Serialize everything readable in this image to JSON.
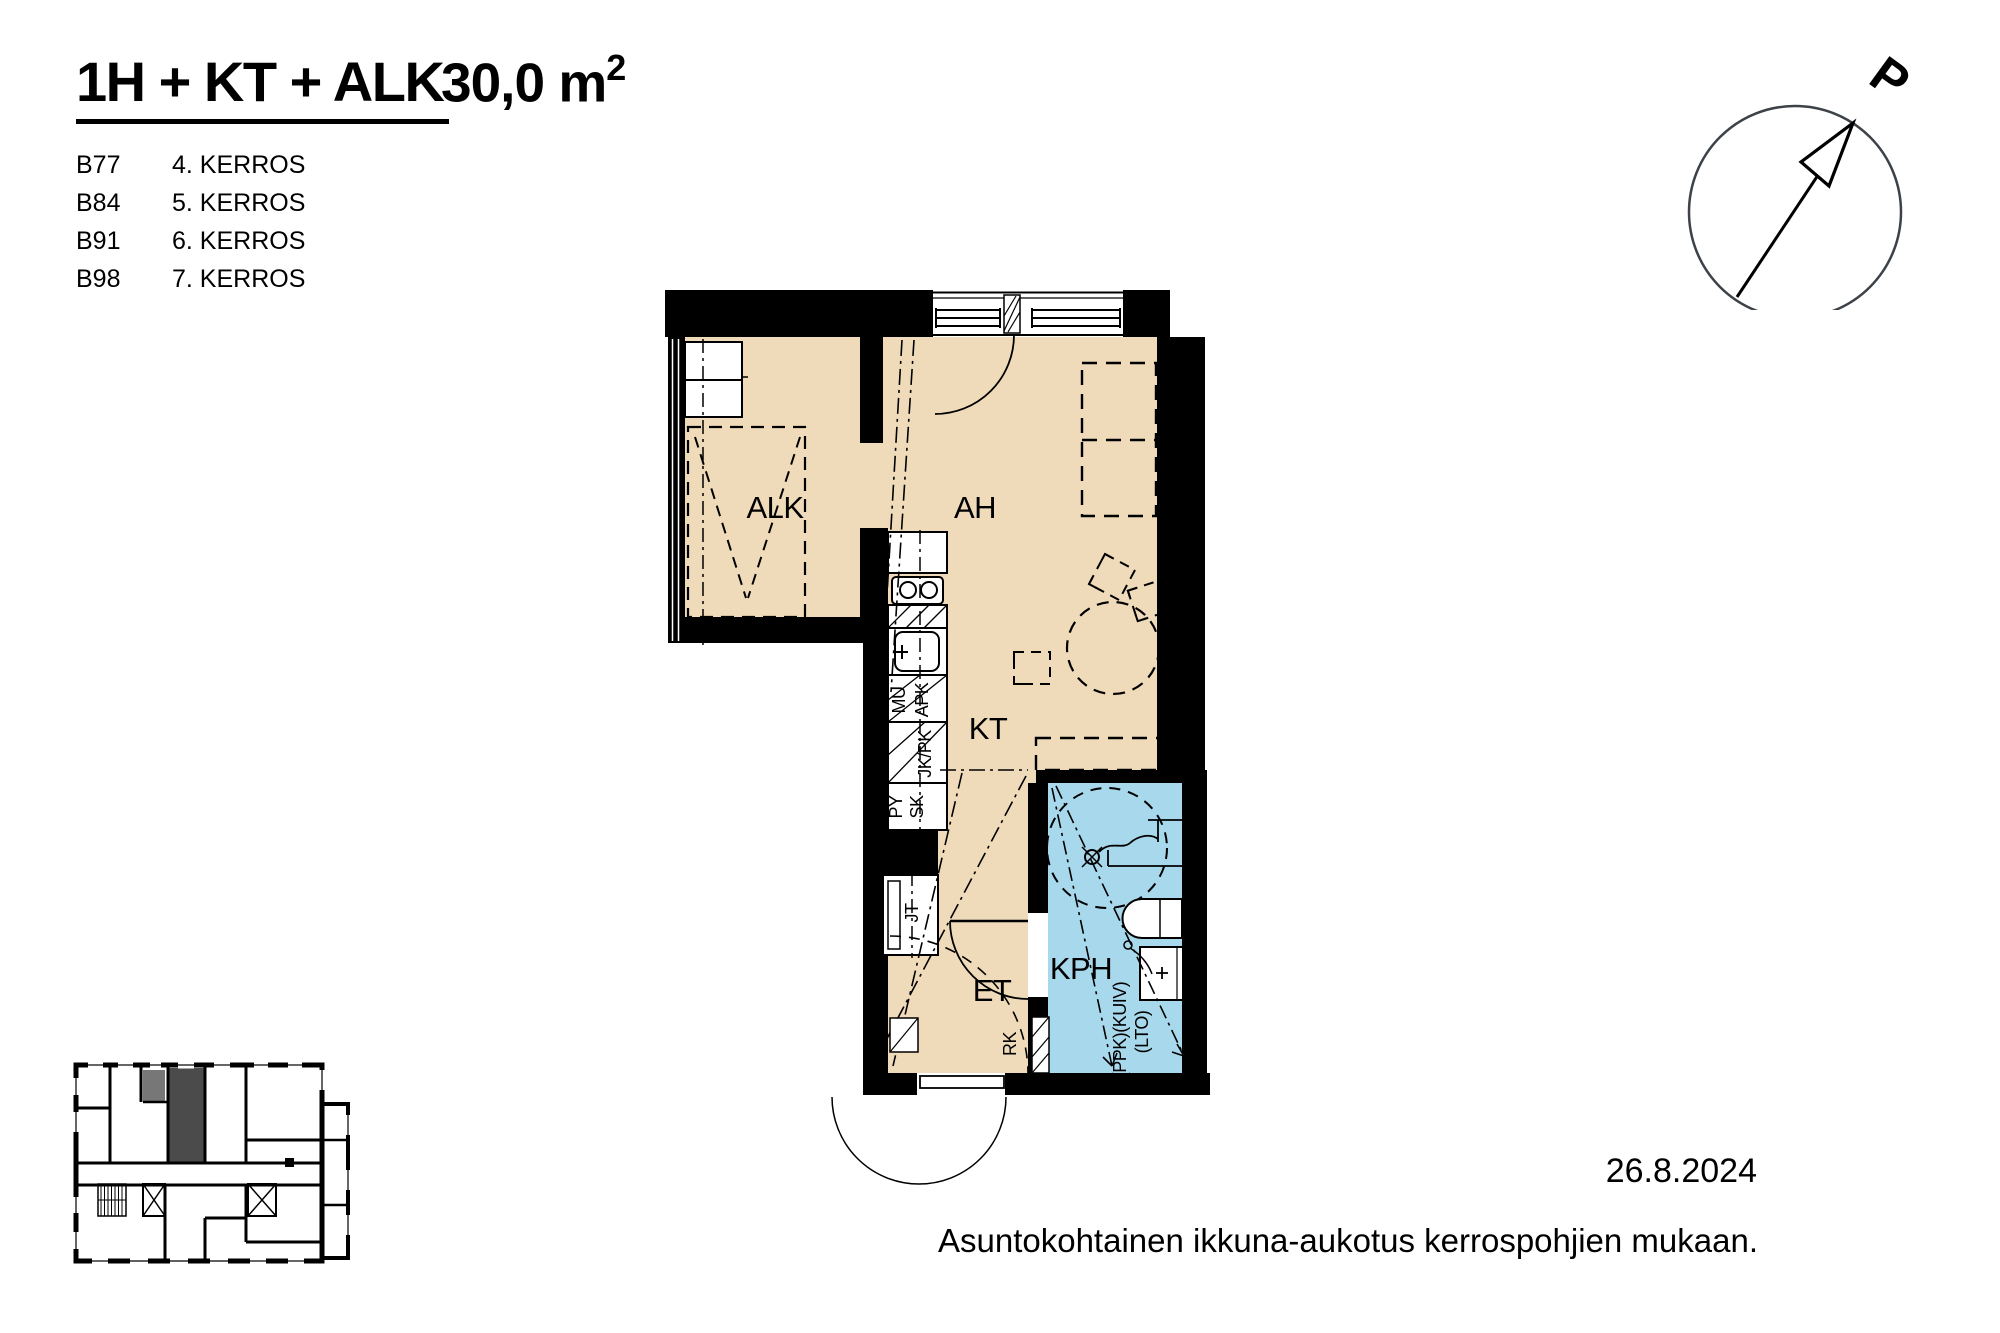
{
  "header": {
    "title": "1H + KT + ALK",
    "area_value": "30,0 m",
    "area_sup": "2",
    "apartments": [
      {
        "id": "B77",
        "floor": "4. KERROS"
      },
      {
        "id": "B84",
        "floor": "5. KERROS"
      },
      {
        "id": "B91",
        "floor": "6. KERROS"
      },
      {
        "id": "B98",
        "floor": "7. KERROS"
      }
    ]
  },
  "compass": {
    "label": "P"
  },
  "plan": {
    "rooms": {
      "alk": "ALK",
      "ah": "AH",
      "kt": "KT",
      "et": "ET",
      "kph": "KPH"
    },
    "fixtures": {
      "mu": "MU",
      "apk": "APK",
      "jkpk": "JK/PK",
      "py": "PY",
      "sk": "SK",
      "jt": "JT",
      "rk": "RK",
      "ppk_kuiv": "(PPK)(KUIV)",
      "lto": "(LTO)"
    },
    "colors": {
      "floor": "#efdbba",
      "wet": "#a8d8eb",
      "highlight_dark": "#4b4b4b",
      "highlight_mid": "#777777"
    }
  },
  "footer": {
    "date": "26.8.2024",
    "note": "Asuntokohtainen ikkuna-aukotus kerrospohjien mukaan."
  }
}
